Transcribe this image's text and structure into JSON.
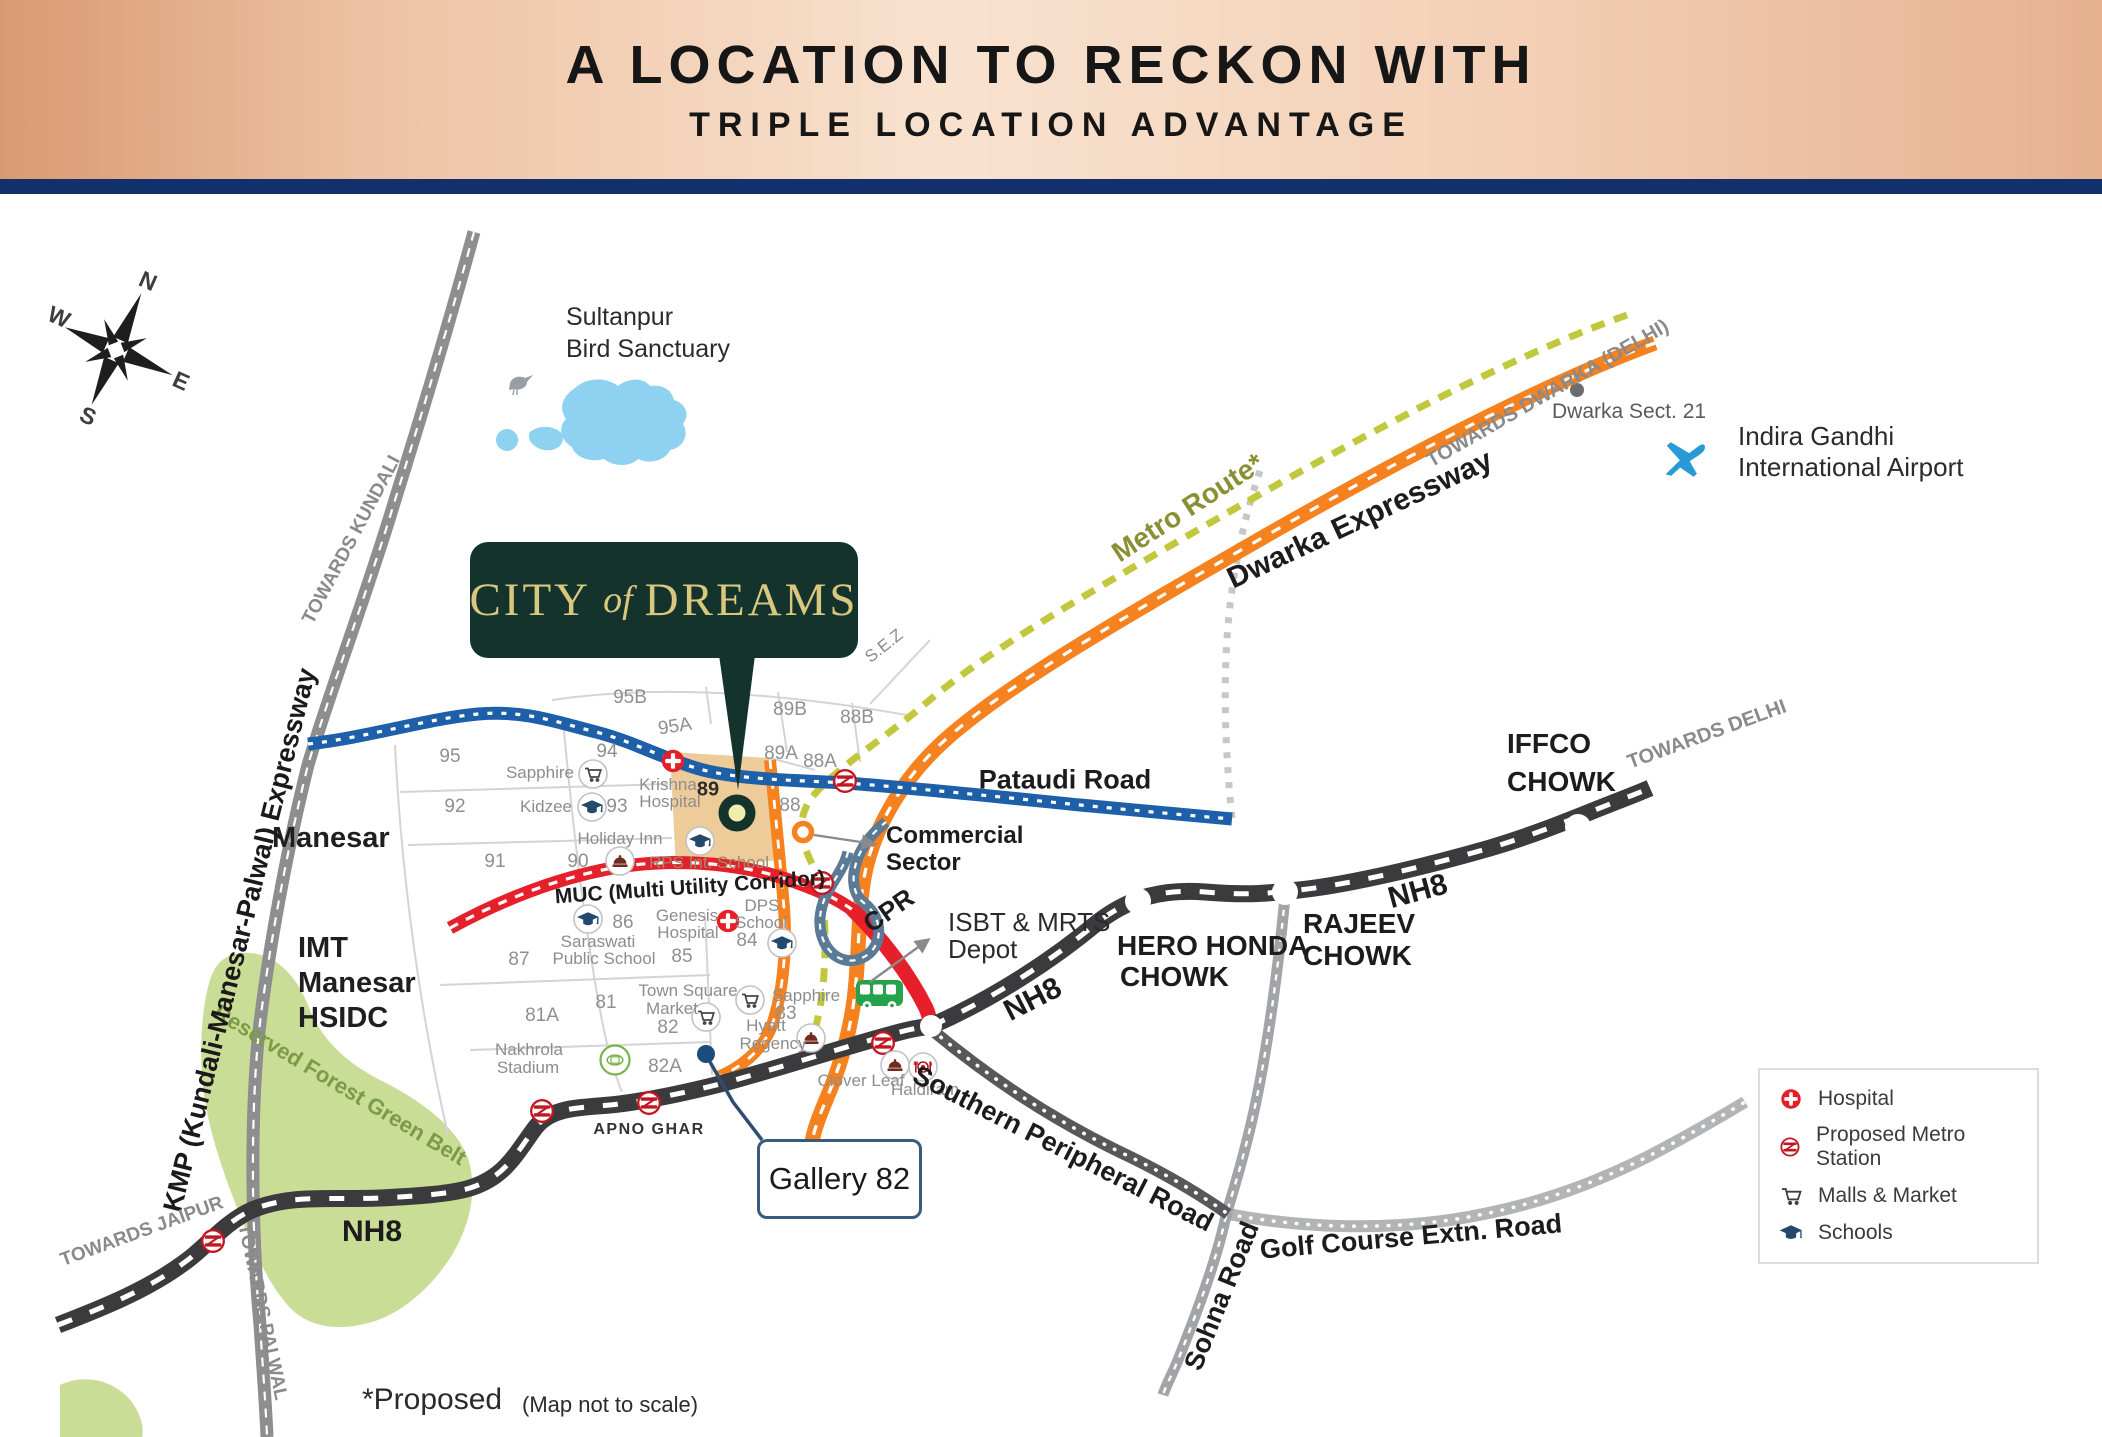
{
  "header": {
    "title": "A LOCATION TO RECKON WITH",
    "subtitle": "TRIPLE LOCATION ADVANTAGE"
  },
  "project": {
    "city": "CITY",
    "of": "of",
    "dreams": "DREAMS"
  },
  "compass": {
    "n": "N",
    "e": "E",
    "s": "S",
    "w": "W"
  },
  "roads": {
    "kmp": "KMP (Kundali-Manesar-Palwal) Expressway",
    "nh8_sw": "NH8",
    "nh8_mid": "NH8",
    "nh8_ne": "NH8",
    "pataudi": "Pataudi Road",
    "muc": "MUC (Multi Utility Corridor)",
    "dwarka": "Dwarka Expressway",
    "metro": "Metro Route*",
    "cpr": "CPR",
    "spr": "Southern Peripheral Road",
    "golf": "Golf Course Extn. Road",
    "sohna": "Sohna Road"
  },
  "directions": {
    "kundali": "TOWARDS KUNDALI",
    "palwal": "TOWARDS PALWAL",
    "jaipur": "TOWARDS JAIPUR",
    "delhi": "TOWARDS DELHI",
    "dwarka_delhi": "TOWARDS DWARKA (DELHI)"
  },
  "junctions": {
    "hero_l1": "HERO HONDA",
    "hero_l2": "CHOWK",
    "rajeev_l1": "RAJEEV",
    "rajeev_l2": "CHOWK",
    "iffco_l1": "IFFCO",
    "iffco_l2": "CHOWK"
  },
  "places": {
    "sultanpur_l1": "Sultanpur",
    "sultanpur_l2": "Bird Sanctuary",
    "airport_l1": "Indira Gandhi",
    "airport_l2": "International Airport",
    "dwarka21": "Dwarka Sect. 21",
    "manesar": "Manesar",
    "imt_l1": "IMT",
    "imt_l2": "Manesar",
    "imt_l3": "HSIDC",
    "greenbelt": "Reserved Forest Green Belt",
    "sez": "S.E.Z",
    "apnoghar": "APNO GHAR",
    "gallery": "Gallery 82",
    "commercial_l1": "Commercial",
    "commercial_l2": "Sector",
    "isbt_l1": "ISBT & MRTS",
    "isbt_l2": "Depot",
    "clover": "Clover Leaf",
    "haldiram": "Haldiram",
    "nakhrola_l1": "Nakhrola",
    "nakhrola_l2": "Stadium"
  },
  "pois": {
    "sapphire94": "Sapphire",
    "krishna_l1": "Krishna",
    "krishna_l2": "Hospital",
    "kidzee": "Kidzee",
    "holiday": "Holiday Inn",
    "rps": "RPS Int. School",
    "saraswati_l1": "Saraswati",
    "saraswati_l2": "Public School",
    "genesis_l1": "Genesis",
    "genesis_l2": "Hospital",
    "dps_l1": "DPS",
    "dps_l2": "School",
    "town_l1": "Town Square",
    "town_l2": "Market",
    "sapphire83": "Sapphire",
    "hyatt_l1": "Hyatt",
    "hyatt_l2": "Regency"
  },
  "sectors": {
    "s95": "95",
    "s95a": "95A",
    "s95b": "95B",
    "s94": "94",
    "s93": "93",
    "s92": "92",
    "s91": "91",
    "s90": "90",
    "s89": "89",
    "s89a": "89A",
    "s89b": "89B",
    "s88": "88",
    "s88a": "88A",
    "s88b": "88B",
    "s87": "87",
    "s86": "86",
    "s85": "85",
    "s84": "84",
    "s83": "83",
    "s82": "82",
    "s82a": "82A",
    "s81": "81",
    "s81a": "81A"
  },
  "legend": {
    "hospital": "Hospital",
    "metro": "Proposed Metro Station",
    "malls": "Malls & Market",
    "schools": "Schools"
  },
  "footnotes": {
    "proposed": "*Proposed",
    "scale": "(Map not to scale)"
  },
  "colors": {
    "header_navy": "#12306b",
    "expressway_orange": "#f5821f",
    "metro_olive": "#c2c83e",
    "muc_red": "#e5202b",
    "pataudi_blue": "#1d5fa8",
    "nh8_dark": "#3b3b3d",
    "cpr_slate": "#5b7a96",
    "logo_green": "#14332c",
    "logo_gold": "#d8c77d",
    "green_belt": "#cadd97",
    "water_blue": "#8ed1f0",
    "sector_tan": "#ecc78f"
  }
}
